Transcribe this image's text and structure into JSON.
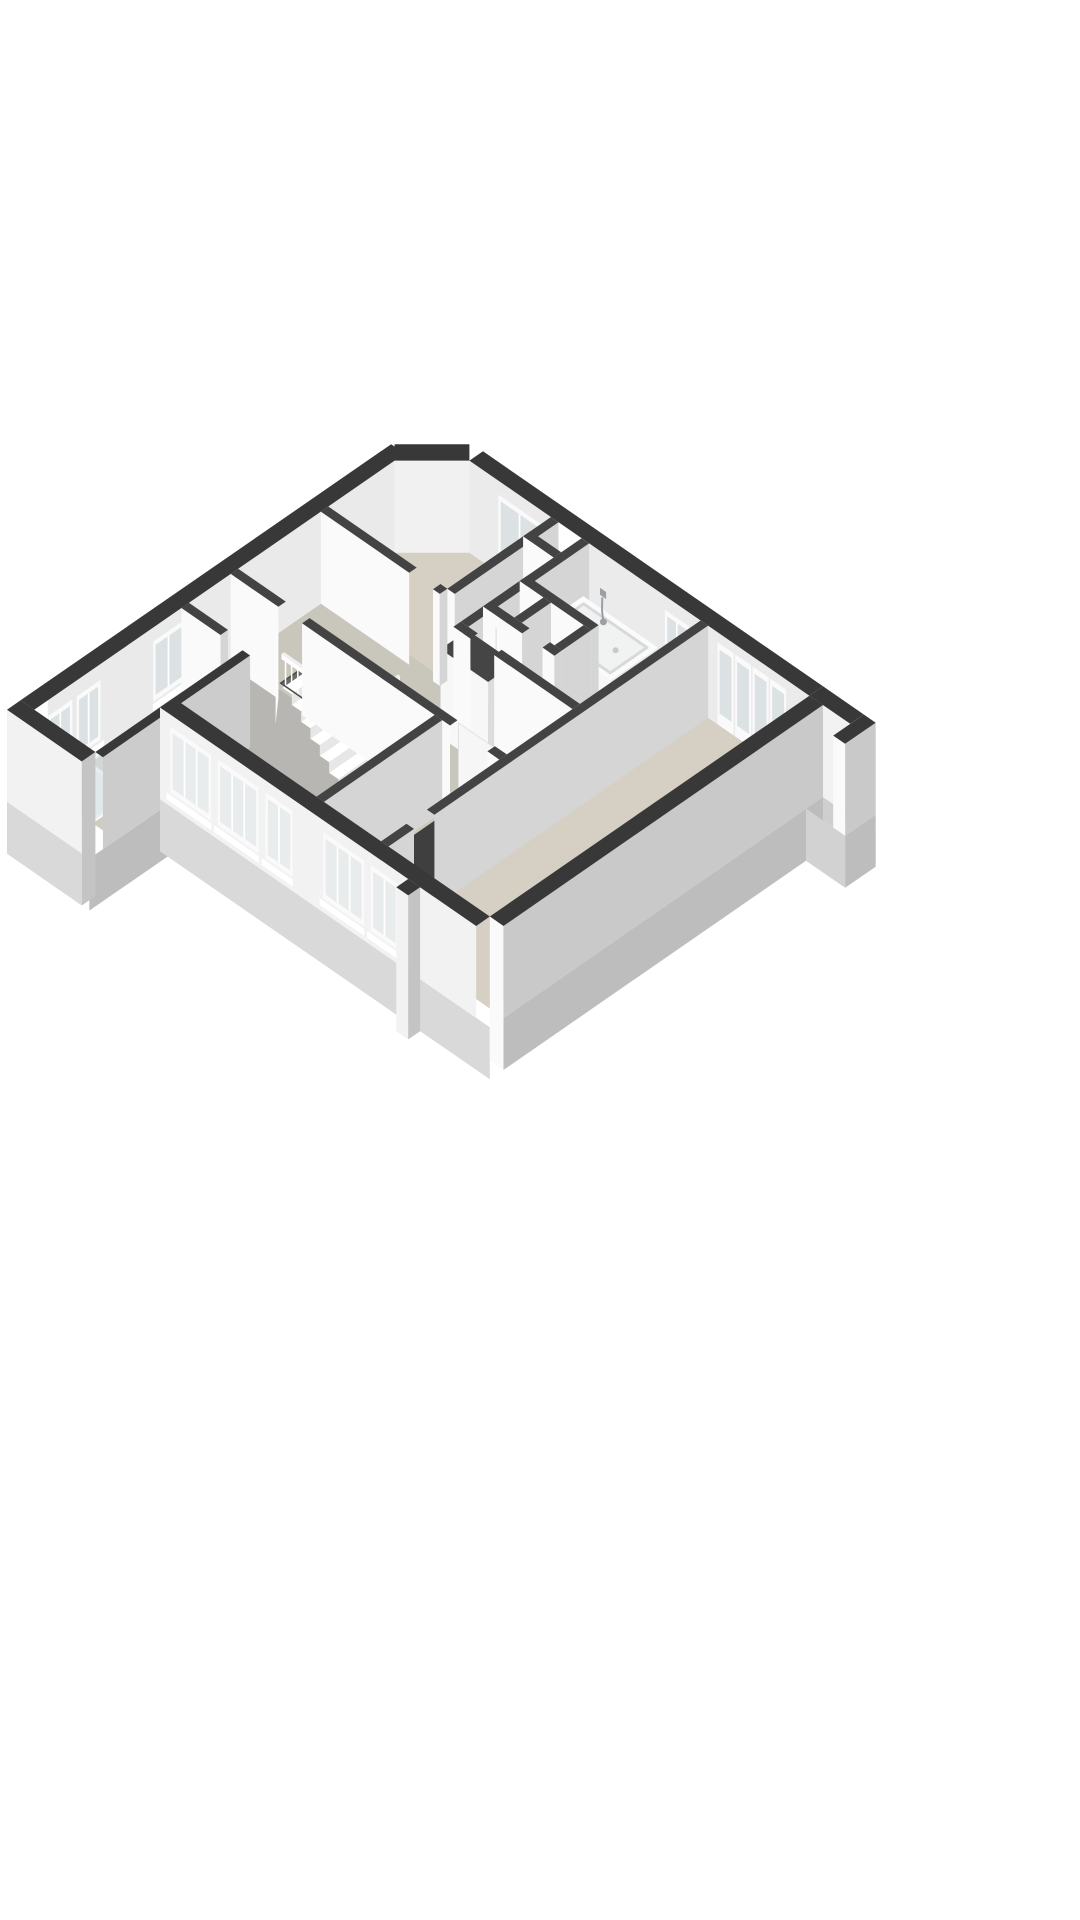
{
  "scene": {
    "type": "3d-floor-plan-isometric",
    "background": "#ffffff",
    "floor_shown": "upper-floor"
  },
  "palette": {
    "capExt": "#383838",
    "capInt": "#434343",
    "faceSW": "#fafafa",
    "faceSE": "#d5d5d5",
    "faceNEint": "#ebebeb",
    "faceNWint": "#eaeaea",
    "chamfer": "#f1f1f1",
    "extBrightWall": "#f2f2f2",
    "extGrayWall": "#c9c9c9",
    "skirtBright": "#d9d9d9",
    "skirtGray": "#bdbdbd",
    "floorBeige": "#d5d0c3",
    "floorBeige2": "#cec9bb",
    "floorHall": "#c9c6bb",
    "floorGray": "#b7b6b2",
    "floorShower": "#d0ccc0",
    "floorNiche": "#8f8f8f",
    "floorBalcony": "#cfcfcf",
    "glassFar": "#dce1e3",
    "glassNear": "#e9ecec",
    "frame": "#fafafa",
    "white": "#ffffff",
    "tread": "#ffffff",
    "riser": "#e7e7e7",
    "holeDeep": "#6b6b6b",
    "holeEdge": "#4a4a4a",
    "tubPlinth": "#2e2e2e",
    "tubFront": "#f7f7f7",
    "tubSide": "#e9e9e9",
    "tubTop": "#fbfbfb",
    "basinFill": "#f1f2f2",
    "basinEdge": "#d6dada",
    "metal": "#9aa0a3",
    "darkGap": "#3f3f3f",
    "glassShower": "#d7e4e9",
    "leaf": "#fcfcfc",
    "slidingLeaf": "#f6f6f6",
    "seam": "#dcdcdc"
  },
  "rooms": [
    {
      "id": "north-bedroom",
      "floor": "floorBeige"
    },
    {
      "id": "bathroom",
      "floor": "floorBeige"
    },
    {
      "id": "toilet",
      "floor": "floorBeige"
    },
    {
      "id": "hallway-landing",
      "floor": "floorHall"
    },
    {
      "id": "stairwell",
      "floor": "tread"
    },
    {
      "id": "southwest-bedroom",
      "floor": "floorGray"
    },
    {
      "id": "south-bedroom",
      "floor": "floorBeige2"
    },
    {
      "id": "living-room",
      "floor": "floorBeige"
    },
    {
      "id": "shower-room-annex",
      "floor": "floorShower"
    },
    {
      "id": "balcony",
      "floor": "floorBalcony"
    }
  ],
  "fixtures": [
    "bathtub",
    "bath-faucet",
    "hand-basin",
    "basin-faucet",
    "shower-enclosure-glass",
    "shower-head",
    "staircase",
    "stair-railing",
    "door-leaf-bedroom",
    "door-leaf-bathroom",
    "door-leaf-southwest-bedroom",
    "sliding-door",
    "closets"
  ],
  "openings": {
    "ne_wall_windows": 2,
    "ne_wall_french_panels": 4,
    "nw_wall_windows": 3,
    "sw_wall_windows": 5,
    "interior_door_gaps": 6
  }
}
